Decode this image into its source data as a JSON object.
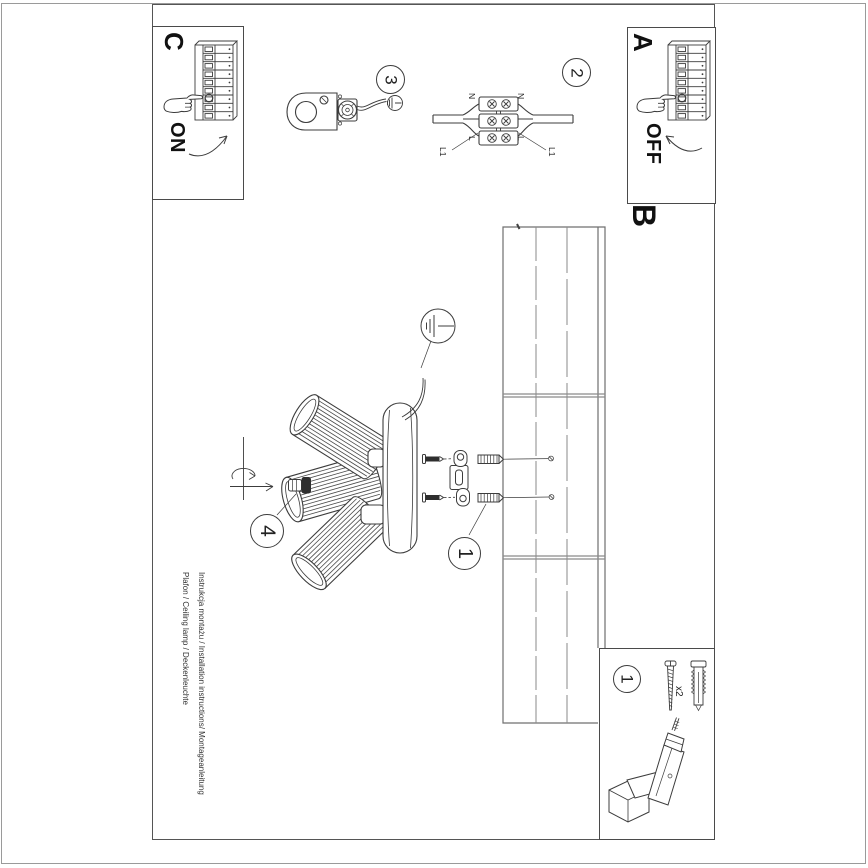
{
  "colors": {
    "ink": "#3c3c3c",
    "frame": "#4a4a4a",
    "page_edge": "#9a9a9a",
    "ceiling_line": "#8a8a8a",
    "text": "#1e1e1e"
  },
  "panels": {
    "c": {
      "label": "C",
      "action": "ON"
    },
    "a": {
      "label": "A",
      "action": "OFF"
    },
    "b": {
      "label": "B"
    }
  },
  "step_numbers": {
    "one": "1",
    "two": "2",
    "three": "3",
    "four": "4"
  },
  "parts_box": {
    "number": "1",
    "quantity": "x2"
  },
  "wiring": {
    "n_left": "N",
    "n_right": "N",
    "l_left": "L",
    "l_right": "L",
    "l1_left": "L1",
    "l1_right": "L1"
  },
  "footer": {
    "line1": "Instrukcja montażu / Installation instructions/ Montageanleitung",
    "line2": "Plafon / Ceiling lamp / Deckenleuchte"
  }
}
